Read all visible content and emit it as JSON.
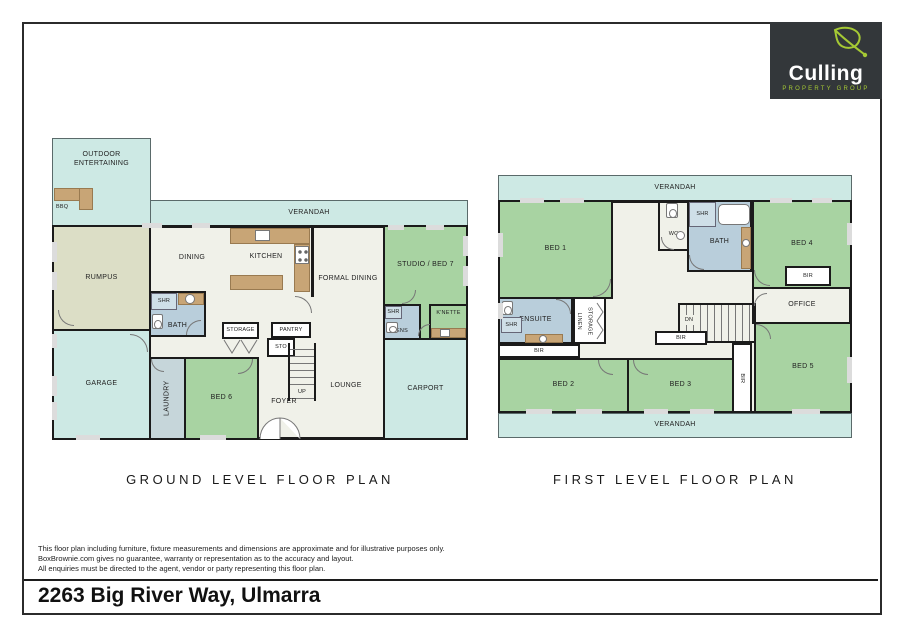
{
  "page": {
    "address": "2263 Big River Way, Ulmarra",
    "disclaimer_lines": [
      "This floor plan including furniture, fixture measurements and dimensions are approximate and for illustrative purposes only.",
      "BoxBrownie.com gives no guarantee, warranty or representation as to the accuracy and layout.",
      "All enquiries must be directed to the agent, vendor or party representing this floor plan."
    ]
  },
  "logo": {
    "name": "Culling",
    "tagline": "PROPERTY GROUP"
  },
  "titles": {
    "ground": "GROUND LEVEL FLOOR PLAN",
    "first": "FIRST LEVEL FLOOR PLAN"
  },
  "colors": {
    "verandah": "#cde9e4",
    "bedroom": "#a8d3a2",
    "rumpus": "#dcdec6",
    "wet": "#b9cedb",
    "shower": "#cfdfe8",
    "laundry": "#c6d6da",
    "floor": "#f0f1e9",
    "counter": "#c8a576",
    "wall": "#1b1b1b",
    "logo_bg": "#33373a",
    "logo_green": "#a5c934"
  },
  "ground": {
    "rooms": {
      "outdoor": "OUTDOOR\nENTERTAINING",
      "bbq": "BBQ",
      "verandah": "VERANDAH",
      "rumpus": "RUMPUS",
      "garage": "GARAGE",
      "dining": "DINING",
      "kitchen": "KITCHEN",
      "formal_dining": "FORMAL DINING",
      "studio": "STUDIO / BED 7",
      "bath": "BATH",
      "shr_bath": "SHR",
      "storage": "STORAGE",
      "pantry": "PANTRY",
      "sto": "STO",
      "laundry": "LAUNDRY",
      "bed6": "BED 6",
      "foyer": "FOYER",
      "up": "UP",
      "lounge": "LOUNGE",
      "carport": "CARPORT",
      "ens": "ENS",
      "shr_ens": "SHR",
      "knette": "K'NETTE"
    }
  },
  "first": {
    "rooms": {
      "verandah_top": "VERANDAH",
      "verandah_bottom": "VERANDAH",
      "bed1": "BED 1",
      "wc": "WC",
      "shr_bath": "SHR",
      "bath": "BATH",
      "bed4": "BED 4",
      "bir_bed4": "BIR",
      "office": "OFFICE",
      "ensuite": "ENSUITE",
      "shr_ensuite": "SHR",
      "linen": "LINEN",
      "storage": "STORAGE",
      "bir_ensuite": "BIR",
      "dn": "DN",
      "bir_hall": "BIR",
      "bed2": "BED 2",
      "bed3": "BED 3",
      "bir_bed3": "BIR",
      "bed5": "BED 5"
    }
  }
}
